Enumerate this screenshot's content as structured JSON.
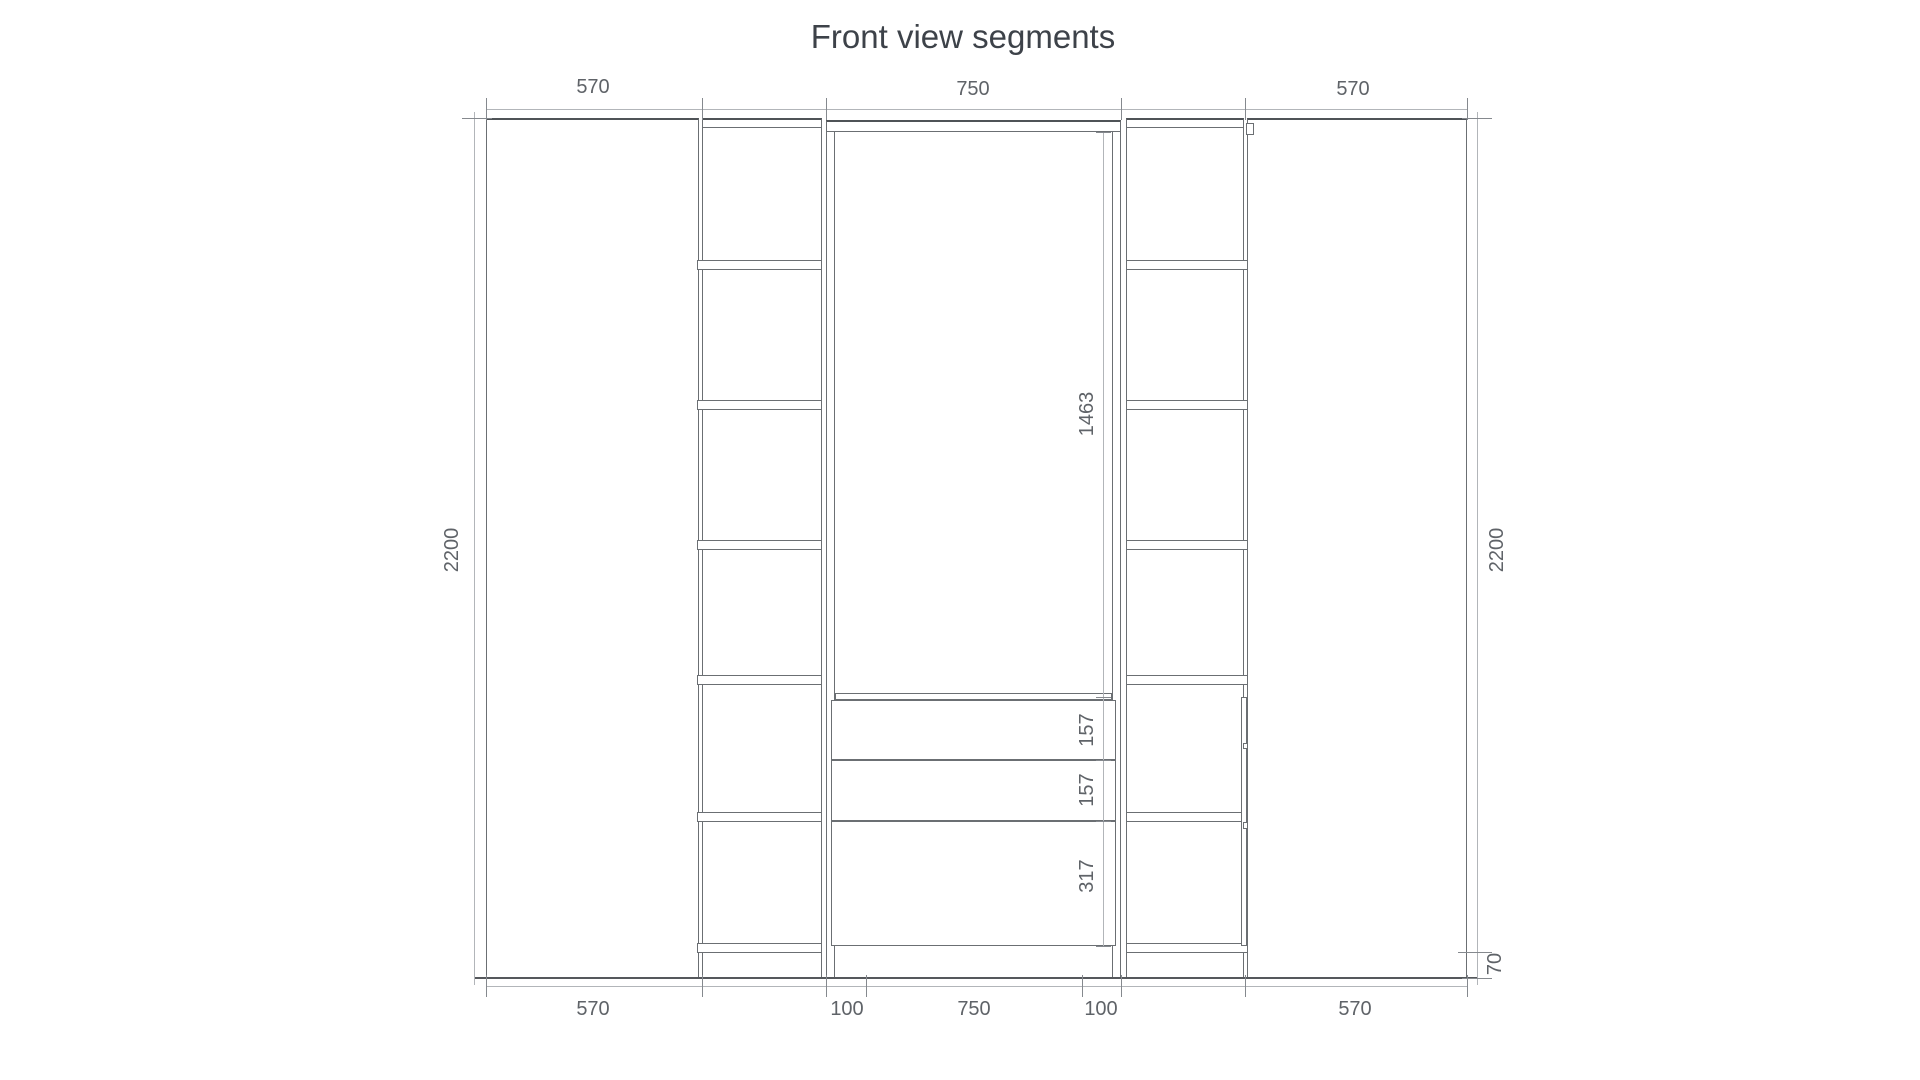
{
  "title": "Front view segments",
  "dimensions": {
    "top_left": "570",
    "top_center": "750",
    "top_right": "570",
    "bottom_left": "570",
    "bottom_inset_left": "100",
    "bottom_center": "750",
    "bottom_inset_right": "100",
    "bottom_right": "570",
    "left_height": "2200",
    "right_height": "2200",
    "hanging_section_height": "1463",
    "drawer_top": "157",
    "drawer_middle": "157",
    "drawer_bottom": "317",
    "plinth_height": "70"
  },
  "colors": {
    "background": "#ffffff",
    "furniture_line": "#6b6f73",
    "furniture_edge_dark": "#4f5357",
    "dimension_line": "#b2b5b9",
    "dimension_text": "#5f6368",
    "title_text": "#3d4249"
  }
}
